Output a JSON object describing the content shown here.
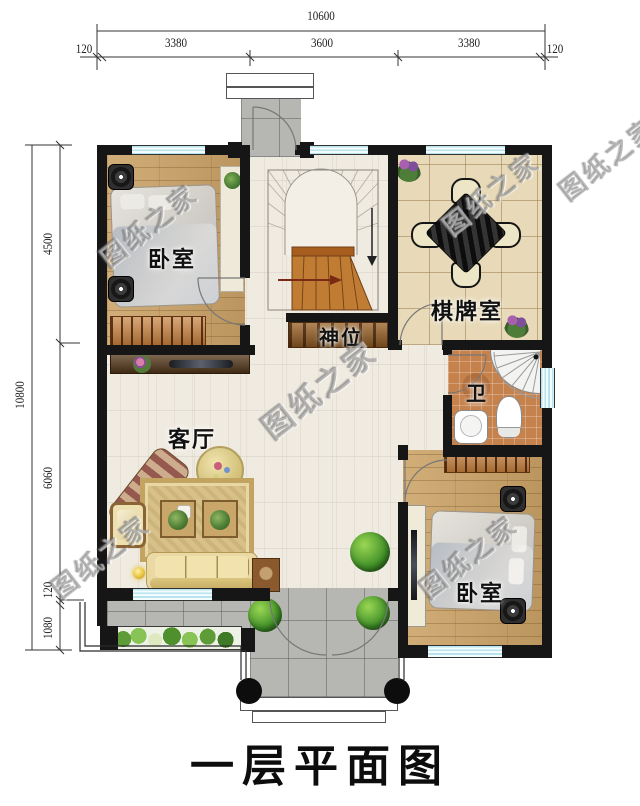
{
  "title": {
    "text": "一层平面图"
  },
  "watermark": {
    "text": "图纸之家"
  },
  "rooms": {
    "bedroom_top": {
      "label": "卧室"
    },
    "chess_room": {
      "label": "棋牌室"
    },
    "shrine": {
      "label": "神位"
    },
    "bathroom": {
      "label": "卫"
    },
    "living_room": {
      "label": "客厅"
    },
    "bedroom_bottom": {
      "label": "卧室"
    }
  },
  "dimensions": {
    "top_total": "10600",
    "top_segments": [
      "120",
      "3380",
      "3600",
      "3380",
      "120"
    ],
    "left_total": "10800",
    "left_segments": [
      "4500",
      "6060",
      "120",
      "1080"
    ]
  },
  "colors": {
    "wall": "#161616",
    "wood_floor": "#cba266",
    "tile_floor": "#e8dab8",
    "bath_floor": "#c5824d",
    "terrace": "#b6b6b3",
    "window_stripe": "#9fd8e4",
    "wardrobe": "#c8813c",
    "stair_wood": "#c07c33",
    "sofa": "#ead9a4",
    "text": "#111111"
  }
}
